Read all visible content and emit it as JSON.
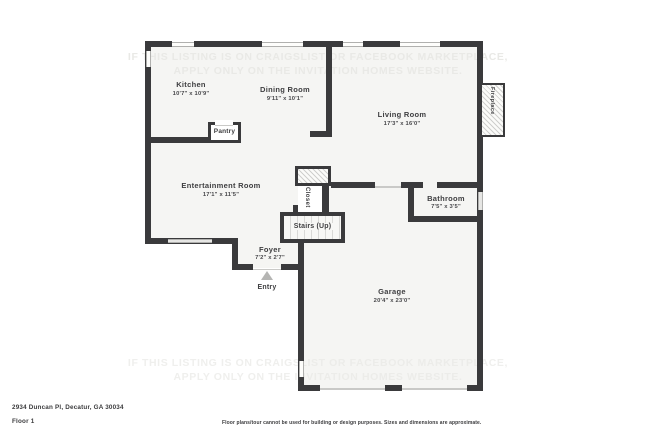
{
  "watermark": {
    "line1": "IF THIS LISTING IS ON CRAIGSLIST OR FACEBOOK MARKETPLACE,",
    "line2": "APPLY ONLY ON THE INVITATION HOMES WEBSITE."
  },
  "rooms": {
    "kitchen": {
      "name": "Kitchen",
      "dims": "10'7\" x 10'9\""
    },
    "dining_room": {
      "name": "Dining Room",
      "dims": "9'11\" x 10'1\""
    },
    "living_room": {
      "name": "Living Room",
      "dims": "17'3\" x 16'0\""
    },
    "entertainment_room": {
      "name": "Entertainment Room",
      "dims": "17'1\" x 11'5\""
    },
    "foyer": {
      "name": "Foyer",
      "dims": "7'2\" x 2'7\""
    },
    "bathroom": {
      "name": "Bathroom",
      "dims": "7'5\" x 3'5\""
    },
    "garage": {
      "name": "Garage",
      "dims": "20'4\" x 23'0\""
    },
    "pantry": {
      "name": "Pantry"
    },
    "closet": {
      "name": "Closet"
    },
    "stairs": {
      "name": "Stairs (Up)"
    },
    "fireplace": {
      "name": "Fireplace"
    },
    "entry": {
      "name": "Entry"
    }
  },
  "footer": {
    "address": "2934 Duncan Pl, Decatur, GA 30034",
    "floor": "Floor 1",
    "disclaimer": "Floor plans/tour cannot be used for building or design purposes. Sizes and dimensions are approximate."
  },
  "colors": {
    "wall": "#3a3a3c",
    "floor": "#f5f5f3",
    "window": "#e6e6e4",
    "text": "#3e3e40",
    "watermark": "#e9e9e6"
  }
}
